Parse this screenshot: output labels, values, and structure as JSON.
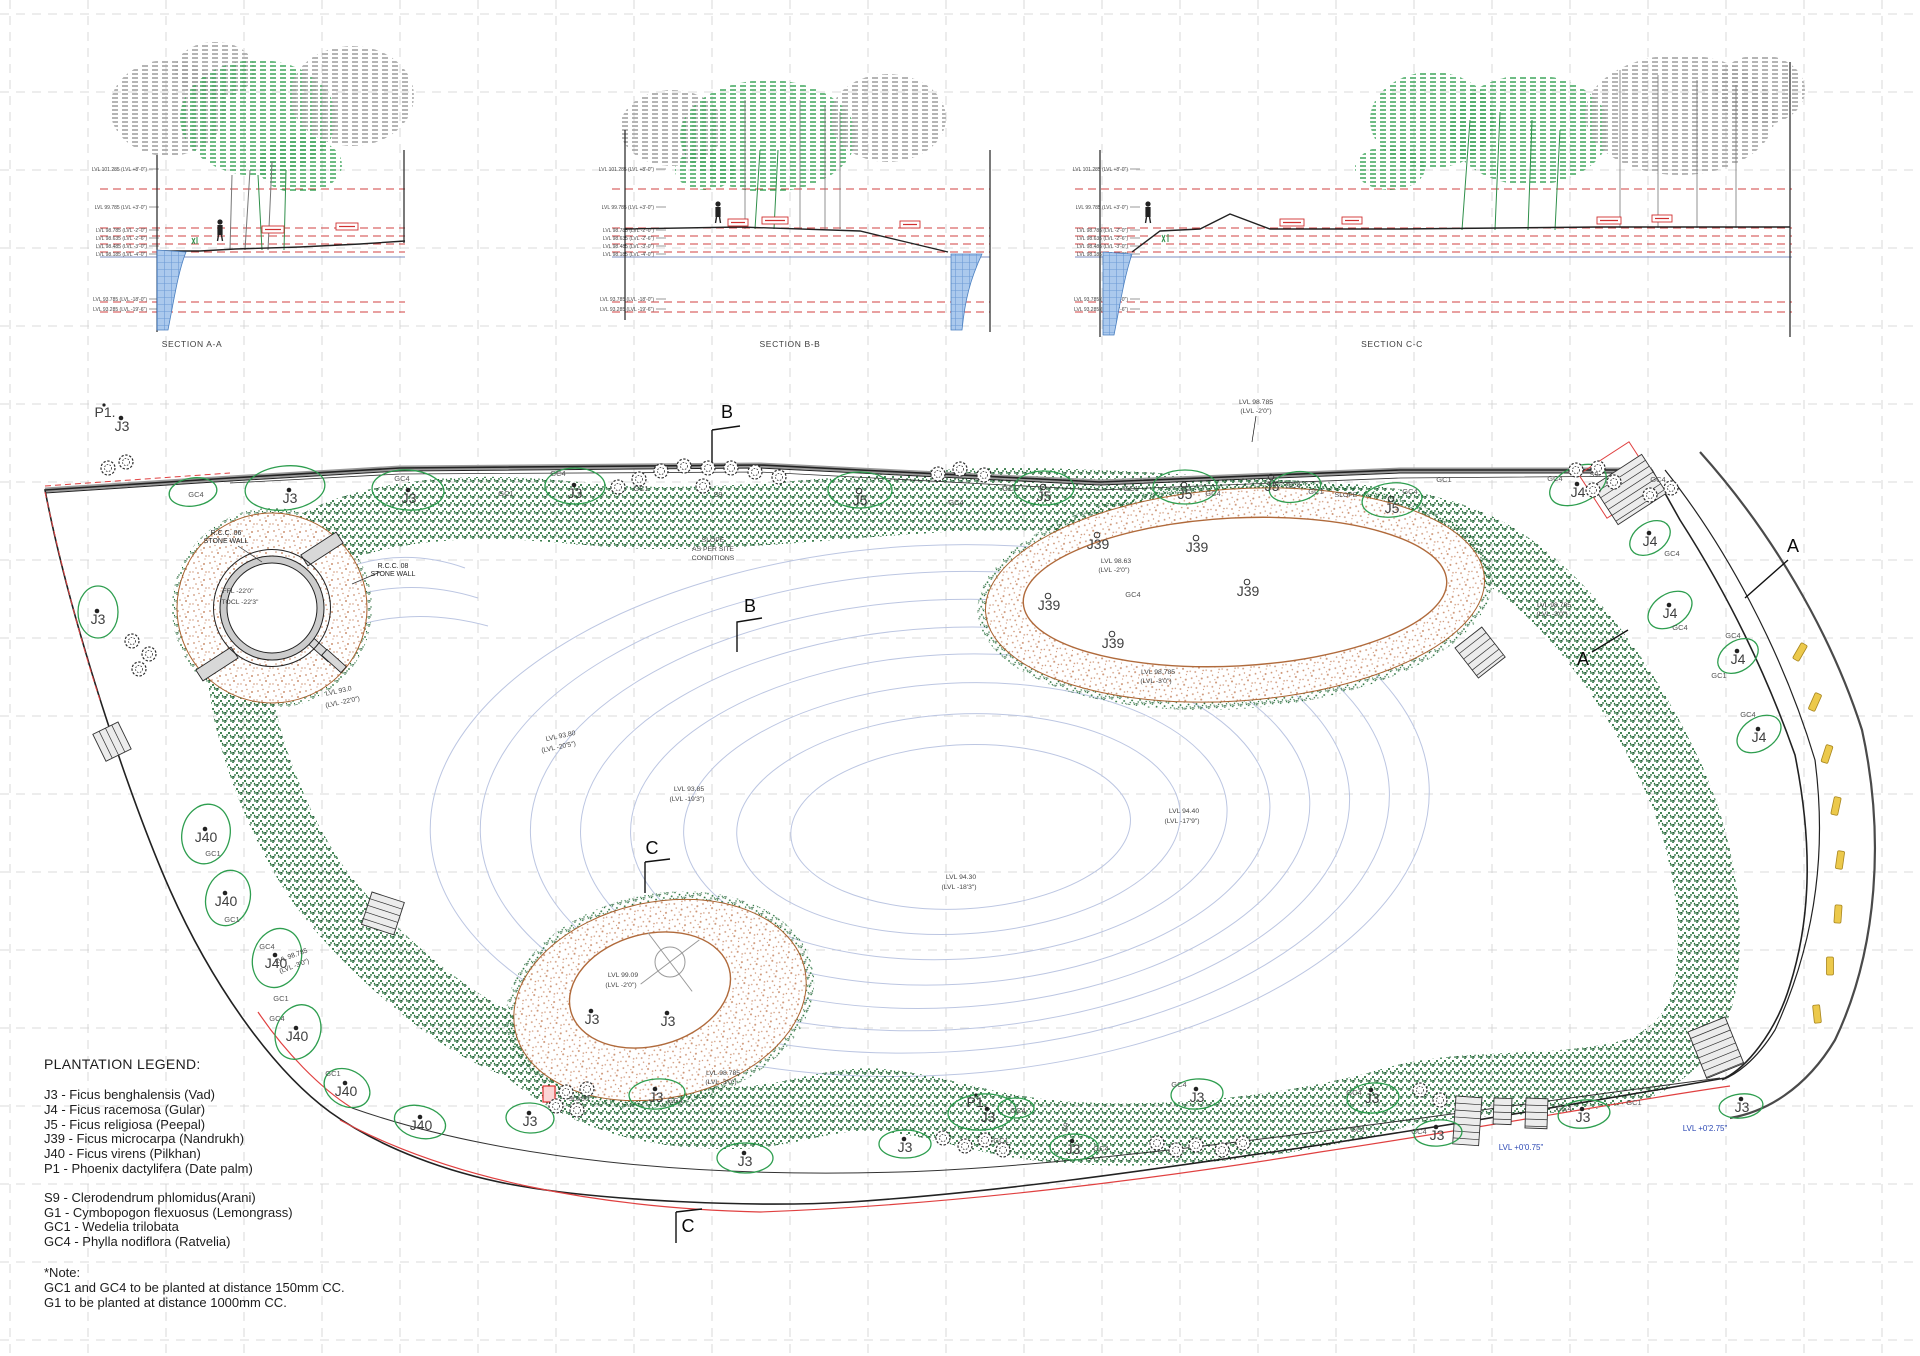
{
  "legend": {
    "title": "PLANTATION LEGEND:",
    "trees": [
      "J3 - Ficus benghalensis (Vad)",
      "J4 - Ficus racemosa (Gular)",
      "J5 - Ficus religiosa (Peepal)",
      "J39 - Ficus microcarpa (Nandrukh)",
      "J40 - Ficus virens (Pilkhan)",
      "P1 - Phoenix dactylifera (Date palm)"
    ],
    "shrubs": [
      "S9 - Clerodendrum phlomidus(Arani)",
      "G1 - Cymbopogon flexuosus (Lemongrass)",
      "GC1 - Wedelia trilobata",
      "GC4 - Phylla nodiflora (Ratvelia)"
    ],
    "note_title": "*Note:",
    "notes": [
      "GC1 and GC4 to be planted at distance 150mm CC.",
      "G1 to be planted at distance 1000mm CC."
    ]
  },
  "sections": {
    "level_values": [
      "LVL 101.285 (LVL +8'-0\")",
      "LVL 99.785 (LVL +3'-0\")",
      "LVL 98.785 (LVL -2'-0\")",
      "LVL 98.635 (LVL -2'-6\")",
      "LVL 98.485 (LVL -3'-0\")",
      "LVL 98.185 (LVL -4'-0\")",
      "LVL 93.785 (LVL -18'-0\")",
      "LVL 93.285 (LVL -19'-6\")"
    ],
    "level_ys": [
      171,
      209,
      232,
      240,
      248,
      256,
      301,
      311
    ],
    "red_ys": [
      189,
      228,
      236,
      244,
      252,
      302,
      312
    ],
    "blue_y": 257,
    "cols": [
      {
        "x1": 100,
        "x2": 405,
        "lx": 147
      },
      {
        "x1": 612,
        "x2": 990,
        "lx": 654
      },
      {
        "x1": 1075,
        "x2": 1792,
        "lx": 1128
      }
    ]
  },
  "plan": {
    "annotations": [
      {
        "t": "B",
        "x": 727,
        "y": 418,
        "c": "m"
      },
      {
        "t": "B",
        "x": 750,
        "y": 612,
        "c": "m"
      },
      {
        "t": "C",
        "x": 652,
        "y": 854,
        "c": "m"
      },
      {
        "t": "C",
        "x": 688,
        "y": 1232,
        "c": "m"
      },
      {
        "t": "A",
        "x": 1793,
        "y": 552,
        "c": "m"
      },
      {
        "t": "A",
        "x": 1583,
        "y": 665,
        "c": "m"
      },
      {
        "t": "SECTION A-A",
        "x": 192,
        "y": 347,
        "c": "s"
      },
      {
        "t": "SECTION B-B",
        "x": 790,
        "y": 347,
        "c": "s"
      },
      {
        "t": "SECTION C-C",
        "x": 1392,
        "y": 347,
        "c": "s"
      },
      {
        "t": "P1.",
        "x": 105,
        "y": 417,
        "c": "t"
      },
      {
        "t": "J3",
        "x": 122,
        "y": 431,
        "c": "t"
      },
      {
        "t": "J3",
        "x": 290,
        "y": 503,
        "c": "t"
      },
      {
        "t": "J3",
        "x": 409,
        "y": 503,
        "c": "t"
      },
      {
        "t": "J3",
        "x": 575,
        "y": 498,
        "c": "t"
      },
      {
        "t": "J3",
        "x": 98,
        "y": 624,
        "c": "t"
      },
      {
        "t": "J5",
        "x": 860,
        "y": 505,
        "c": "t"
      },
      {
        "t": "J5",
        "x": 1044,
        "y": 501,
        "c": "t"
      },
      {
        "t": "J5",
        "x": 1185,
        "y": 499,
        "c": "t"
      },
      {
        "t": "J5",
        "x": 1392,
        "y": 513,
        "c": "t"
      },
      {
        "t": "J5",
        "x": 1272,
        "y": 491,
        "c": "t"
      },
      {
        "t": "J4",
        "x": 1578,
        "y": 497,
        "c": "t"
      },
      {
        "t": "J4",
        "x": 1650,
        "y": 546,
        "c": "t"
      },
      {
        "t": "J4",
        "x": 1670,
        "y": 618,
        "c": "t"
      },
      {
        "t": "J4",
        "x": 1738,
        "y": 664,
        "c": "t"
      },
      {
        "t": "J4",
        "x": 1759,
        "y": 742,
        "c": "t"
      },
      {
        "t": "J39",
        "x": 1098,
        "y": 549,
        "c": "t"
      },
      {
        "t": "J39",
        "x": 1197,
        "y": 552,
        "c": "t"
      },
      {
        "t": "J39",
        "x": 1049,
        "y": 610,
        "c": "t"
      },
      {
        "t": "J39",
        "x": 1248,
        "y": 596,
        "c": "t"
      },
      {
        "t": "J39",
        "x": 1113,
        "y": 648,
        "c": "t"
      },
      {
        "t": "J40",
        "x": 206,
        "y": 842,
        "c": "t"
      },
      {
        "t": "J40",
        "x": 226,
        "y": 906,
        "c": "t"
      },
      {
        "t": "J40",
        "x": 276,
        "y": 968,
        "c": "t"
      },
      {
        "t": "J40",
        "x": 297,
        "y": 1041,
        "c": "t"
      },
      {
        "t": "J40",
        "x": 346,
        "y": 1096,
        "c": "t"
      },
      {
        "t": "J40",
        "x": 421,
        "y": 1130,
        "c": "t"
      },
      {
        "t": "J3",
        "x": 530,
        "y": 1126,
        "c": "t"
      },
      {
        "t": "J3",
        "x": 656,
        "y": 1102,
        "c": "t"
      },
      {
        "t": "J3",
        "x": 745,
        "y": 1166,
        "c": "t"
      },
      {
        "t": "J3",
        "x": 905,
        "y": 1152,
        "c": "t"
      },
      {
        "t": "P1.",
        "x": 977,
        "y": 1107,
        "c": "t"
      },
      {
        "t": "J3",
        "x": 988,
        "y": 1122,
        "c": "t"
      },
      {
        "t": "J3",
        "x": 1073,
        "y": 1154,
        "c": "t"
      },
      {
        "t": "J3",
        "x": 1197,
        "y": 1102,
        "c": "t"
      },
      {
        "t": "J3",
        "x": 1372,
        "y": 1103,
        "c": "t"
      },
      {
        "t": "J3",
        "x": 1437,
        "y": 1140,
        "c": "t"
      },
      {
        "t": "J3",
        "x": 1583,
        "y": 1122,
        "c": "t"
      },
      {
        "t": "J3",
        "x": 1742,
        "y": 1112,
        "c": "t"
      },
      {
        "t": "J3",
        "x": 592,
        "y": 1024,
        "c": "t"
      },
      {
        "t": "J3",
        "x": 668,
        "y": 1026,
        "c": "t"
      },
      {
        "t": "GC4",
        "x": 196,
        "y": 497,
        "c": "g"
      },
      {
        "t": "GC4",
        "x": 402,
        "y": 481,
        "c": "g"
      },
      {
        "t": "GC4",
        "x": 558,
        "y": 476,
        "c": "g"
      },
      {
        "t": "GC1",
        "x": 506,
        "y": 496,
        "c": "g"
      },
      {
        "t": "GC1",
        "x": 641,
        "y": 491,
        "c": "g"
      },
      {
        "t": "GC4",
        "x": 956,
        "y": 505,
        "c": "g"
      },
      {
        "t": "GC1",
        "x": 1010,
        "y": 491,
        "c": "g"
      },
      {
        "t": "GC4",
        "x": 1213,
        "y": 496,
        "c": "g"
      },
      {
        "t": "GC1",
        "x": 1131,
        "y": 491,
        "c": "g"
      },
      {
        "t": "GC4",
        "x": 1410,
        "y": 494,
        "c": "g"
      },
      {
        "t": "GC1",
        "x": 1316,
        "y": 494,
        "c": "g"
      },
      {
        "t": "GC1",
        "x": 1444,
        "y": 482,
        "c": "g"
      },
      {
        "t": "GC4",
        "x": 1658,
        "y": 482,
        "c": "g"
      },
      {
        "t": "GC4",
        "x": 1555,
        "y": 481,
        "c": "g"
      },
      {
        "t": "GC4",
        "x": 1293,
        "y": 488,
        "c": "g"
      },
      {
        "t": "GC4",
        "x": 1133,
        "y": 597,
        "c": "g"
      },
      {
        "t": "GC4",
        "x": 1672,
        "y": 556,
        "c": "g"
      },
      {
        "t": "GC4",
        "x": 1680,
        "y": 630,
        "c": "g"
      },
      {
        "t": "GC4",
        "x": 1733,
        "y": 638,
        "c": "g"
      },
      {
        "t": "GC4",
        "x": 1748,
        "y": 717,
        "c": "g"
      },
      {
        "t": "GC1",
        "x": 1719,
        "y": 678,
        "c": "g"
      },
      {
        "t": "GC1",
        "x": 213,
        "y": 856,
        "c": "g"
      },
      {
        "t": "GC1",
        "x": 232,
        "y": 922,
        "c": "g"
      },
      {
        "t": "GC4",
        "x": 267,
        "y": 949,
        "c": "g"
      },
      {
        "t": "GC1",
        "x": 281,
        "y": 1001,
        "c": "g"
      },
      {
        "t": "GC4",
        "x": 277,
        "y": 1021,
        "c": "g"
      },
      {
        "t": "GC1",
        "x": 333,
        "y": 1076,
        "c": "g"
      },
      {
        "t": "GC4",
        "x": 675,
        "y": 1103,
        "c": "g"
      },
      {
        "t": "GC1",
        "x": 1001,
        "y": 1143,
        "c": "g"
      },
      {
        "t": "GC4",
        "x": 1018,
        "y": 1113,
        "c": "g"
      },
      {
        "t": "GC4",
        "x": 1101,
        "y": 1151,
        "c": "g"
      },
      {
        "t": "GC4",
        "x": 1179,
        "y": 1087,
        "c": "g"
      },
      {
        "t": "GC4",
        "x": 1354,
        "y": 1095,
        "c": "g"
      },
      {
        "t": "GC1",
        "x": 1358,
        "y": 1132,
        "c": "g"
      },
      {
        "t": "GC4",
        "x": 1419,
        "y": 1134,
        "c": "g"
      },
      {
        "t": "GC4",
        "x": 1564,
        "y": 1111,
        "c": "g"
      },
      {
        "t": "GC1",
        "x": 1634,
        "y": 1105,
        "c": "g"
      },
      {
        "t": "S9",
        "x": 718,
        "y": 497,
        "c": "g"
      },
      {
        "t": "S9",
        "x": 1594,
        "y": 477,
        "c": "g"
      },
      {
        "t": "S9",
        "x": 1068,
        "y": 1128,
        "c": "g",
        "r": -75
      },
      {
        "t": "90x90",
        "x": 579,
        "y": 1101,
        "c": "g"
      },
      {
        "t": "LVL 98.785",
        "x": 1256,
        "y": 404,
        "c": "l"
      },
      {
        "t": "(LVL -2'0\")",
        "x": 1256,
        "y": 413,
        "c": "l"
      },
      {
        "t": "LVL 98.63",
        "x": 1116,
        "y": 563,
        "c": "l"
      },
      {
        "t": "(LVL -2'0\")",
        "x": 1114,
        "y": 572,
        "c": "l"
      },
      {
        "t": "LVL 98.785",
        "x": 1158,
        "y": 674,
        "c": "l"
      },
      {
        "t": "(LVL -3'0\")",
        "x": 1156,
        "y": 683,
        "c": "l"
      },
      {
        "t": "LVL 98.785",
        "x": 1554,
        "y": 607,
        "c": "l"
      },
      {
        "t": "(LVL -3'0\")",
        "x": 1552,
        "y": 616,
        "c": "l"
      },
      {
        "t": "LVL 98.785",
        "x": 292,
        "y": 958,
        "c": "l",
        "r": -20
      },
      {
        "t": "(LVL -3'0\")",
        "x": 295,
        "y": 968,
        "c": "l",
        "r": -20
      },
      {
        "t": "LVL 98.785",
        "x": 723,
        "y": 1075,
        "c": "l"
      },
      {
        "t": "(LVL -3'0\")",
        "x": 721,
        "y": 1084,
        "c": "l"
      },
      {
        "t": "LVL 99.09",
        "x": 623,
        "y": 977,
        "c": "l"
      },
      {
        "t": "(LVL -2'0\")",
        "x": 621,
        "y": 987,
        "c": "l"
      },
      {
        "t": "LVL 94.40",
        "x": 1184,
        "y": 813,
        "c": "l"
      },
      {
        "t": "(LVL -17'9\")",
        "x": 1182,
        "y": 823,
        "c": "l"
      },
      {
        "t": "LVL 94.30",
        "x": 961,
        "y": 879,
        "c": "l"
      },
      {
        "t": "(LVL -18'3\")",
        "x": 959,
        "y": 889,
        "c": "l"
      },
      {
        "t": "LVL 93.85",
        "x": 689,
        "y": 791,
        "c": "l"
      },
      {
        "t": "(LVL -19'3\")",
        "x": 687,
        "y": 801,
        "c": "l"
      },
      {
        "t": "LVL 93.80",
        "x": 561,
        "y": 738,
        "c": "l",
        "r": -12
      },
      {
        "t": "(LVL -20'5\")",
        "x": 559,
        "y": 749,
        "c": "l",
        "r": -12
      },
      {
        "t": "LVL 93.0",
        "x": 339,
        "y": 693,
        "c": "l",
        "r": -12
      },
      {
        "t": "(LVL -22'0\")",
        "x": 343,
        "y": 704,
        "c": "l",
        "r": -12
      },
      {
        "t": "SLOPE",
        "x": 713,
        "y": 542,
        "c": "l"
      },
      {
        "t": "AS PER SITE",
        "x": 713,
        "y": 551,
        "c": "l"
      },
      {
        "t": "CONDITIONS",
        "x": 713,
        "y": 560,
        "c": "l"
      },
      {
        "t": "SLOPE",
        "x": 1346,
        "y": 497,
        "c": "l"
      },
      {
        "t": "FFL -22'0\"",
        "x": 238,
        "y": 593,
        "c": "l"
      },
      {
        "t": "TOCL -22'3\"",
        "x": 240,
        "y": 604,
        "c": "l"
      },
      {
        "t": "R.C.C. 06",
        "x": 226,
        "y": 535,
        "c": "n"
      },
      {
        "t": "STONE WALL",
        "x": 226,
        "y": 543,
        "c": "n"
      },
      {
        "t": "R.C.C. 08",
        "x": 393,
        "y": 568,
        "c": "n"
      },
      {
        "t": "STONE WALL",
        "x": 393,
        "y": 576,
        "c": "n"
      },
      {
        "t": "LVL +0'0.75\"",
        "x": 1521,
        "y": 1150,
        "c": "b"
      },
      {
        "t": "LVL +0'2.75\"",
        "x": 1705,
        "y": 1131,
        "c": "b"
      }
    ],
    "blobs": [
      [
        193,
        492,
        24,
        14,
        -8
      ],
      [
        285,
        488,
        40,
        22,
        -6
      ],
      [
        408,
        490,
        36,
        20,
        4
      ],
      [
        575,
        486,
        30,
        18,
        0
      ],
      [
        860,
        490,
        32,
        18,
        0
      ],
      [
        1044,
        488,
        30,
        17,
        0
      ],
      [
        1185,
        487,
        32,
        17,
        0
      ],
      [
        1392,
        500,
        30,
        17,
        -6
      ],
      [
        1295,
        487,
        26,
        15,
        -10
      ],
      [
        1578,
        485,
        30,
        18,
        -25
      ],
      [
        98,
        612,
        20,
        26,
        0
      ],
      [
        206,
        834,
        24,
        30,
        12
      ],
      [
        228,
        898,
        22,
        28,
        15
      ],
      [
        277,
        958,
        24,
        30,
        18
      ],
      [
        298,
        1032,
        22,
        28,
        22
      ],
      [
        347,
        1088,
        24,
        18,
        28
      ],
      [
        420,
        1122,
        26,
        16,
        14
      ],
      [
        530,
        1118,
        24,
        15,
        2
      ],
      [
        657,
        1094,
        28,
        15,
        -4
      ],
      [
        745,
        1158,
        28,
        15,
        0
      ],
      [
        905,
        1144,
        26,
        14,
        0
      ],
      [
        982,
        1112,
        34,
        18,
        -4
      ],
      [
        1016,
        1108,
        18,
        10,
        0
      ],
      [
        1074,
        1147,
        24,
        13,
        0
      ],
      [
        1197,
        1094,
        26,
        15,
        -4
      ],
      [
        1373,
        1098,
        26,
        15,
        -4
      ],
      [
        1438,
        1133,
        24,
        13,
        -4
      ],
      [
        1584,
        1114,
        26,
        14,
        -6
      ],
      [
        1650,
        538,
        22,
        15,
        -33
      ],
      [
        1670,
        610,
        24,
        16,
        -33
      ],
      [
        1738,
        656,
        22,
        15,
        -33
      ],
      [
        1759,
        734,
        24,
        16,
        -33
      ],
      [
        1741,
        1106,
        22,
        12,
        -6
      ]
    ],
    "shrubs": [
      [
        618,
        487
      ],
      [
        639,
        479
      ],
      [
        661,
        471
      ],
      [
        684,
        466
      ],
      [
        708,
        468
      ],
      [
        703,
        486
      ],
      [
        731,
        468
      ],
      [
        755,
        472
      ],
      [
        779,
        477
      ],
      [
        938,
        474
      ],
      [
        960,
        469
      ],
      [
        984,
        475
      ],
      [
        1576,
        470
      ],
      [
        1598,
        468
      ],
      [
        1614,
        482
      ],
      [
        1593,
        490
      ],
      [
        132,
        641
      ],
      [
        149,
        654
      ],
      [
        139,
        669
      ],
      [
        108,
        468
      ],
      [
        126,
        462
      ],
      [
        566,
        1092
      ],
      [
        587,
        1089
      ],
      [
        556,
        1106
      ],
      [
        577,
        1110
      ],
      [
        943,
        1138
      ],
      [
        965,
        1146
      ],
      [
        985,
        1140
      ],
      [
        1003,
        1150
      ],
      [
        1157,
        1143
      ],
      [
        1176,
        1150
      ],
      [
        1196,
        1145
      ],
      [
        1222,
        1150
      ],
      [
        1243,
        1143
      ],
      [
        1420,
        1090
      ],
      [
        1440,
        1100
      ],
      [
        1650,
        495
      ],
      [
        1671,
        488
      ]
    ],
    "stairs": [
      [
        1593,
        486,
        58,
        46,
        -33
      ],
      [
        1455,
        648,
        34,
        38,
        -38
      ],
      [
        1456,
        1096,
        26,
        48,
        4
      ],
      [
        1494,
        1098,
        18,
        26,
        2
      ],
      [
        1526,
        1098,
        22,
        30,
        2
      ],
      [
        1688,
        1032,
        40,
        50,
        -22
      ],
      [
        372,
        892,
        34,
        34,
        18
      ],
      [
        118,
        722,
        30,
        28,
        64
      ]
    ],
    "ramps": [
      [
        322,
        549,
        42,
        13,
        -33
      ],
      [
        217,
        664,
        42,
        13,
        -33
      ],
      [
        321,
        650,
        26,
        8,
        42
      ],
      [
        334,
        661,
        26,
        8,
        42
      ]
    ],
    "parking": [
      [
        1800,
        652,
        -60
      ],
      [
        1815,
        702,
        -66
      ],
      [
        1827,
        754,
        -72
      ],
      [
        1836,
        806,
        -78
      ],
      [
        1840,
        860,
        -82
      ],
      [
        1838,
        914,
        -86
      ],
      [
        1830,
        966,
        -90
      ],
      [
        1817,
        1014,
        -96
      ]
    ],
    "persons": [
      [
        220,
        236
      ],
      [
        718,
        218
      ],
      [
        1148,
        218
      ]
    ],
    "redtags": [
      [
        262,
        226,
        22
      ],
      [
        336,
        223,
        22
      ],
      [
        728,
        219,
        20
      ],
      [
        762,
        217,
        26
      ],
      [
        900,
        221,
        20
      ],
      [
        1280,
        219,
        24
      ],
      [
        1342,
        217,
        20
      ],
      [
        1597,
        217,
        24
      ],
      [
        1652,
        215,
        20
      ]
    ]
  }
}
